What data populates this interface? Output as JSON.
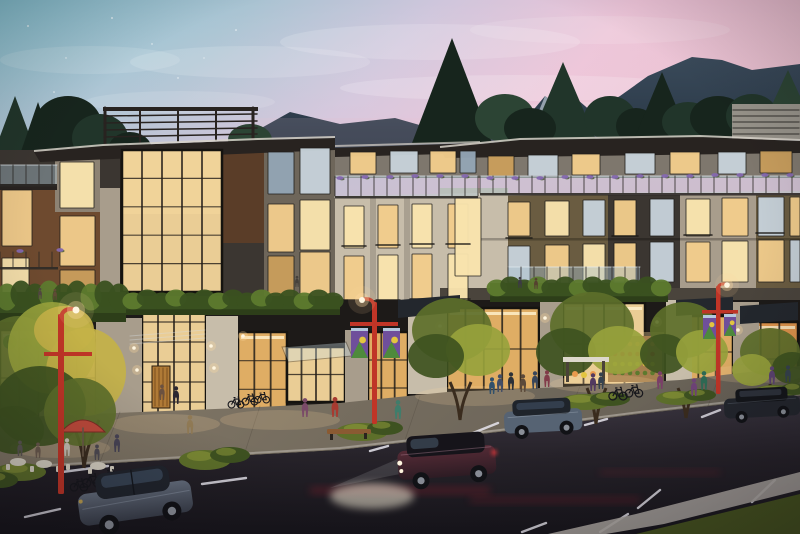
{
  "scene": {
    "type": "architectural-rendering",
    "time_of_day": "dusk",
    "label": "Dusk rendering of a mixed-use residential building with lit shops, tree-lined street, parked cars and mountains behind"
  },
  "palette": {
    "sky_teal": "#84bfce",
    "sky_mid": "#cfc6dc",
    "sky_pink": "#ecc3d7",
    "sky_rose": "#e9bccc",
    "mountain": "#2f3d4a",
    "mountain_dark": "#243240",
    "snow": "#aeb9c4",
    "tree_dark": "#17251d",
    "tree_mid": "#21352a",
    "tree_soft": "#2c4434",
    "roof": "#282320",
    "fascia": "#d7d2c9",
    "roof_screen": "#97938a",
    "wall_bronze": "#6e4a2f",
    "wall_taupe": "#8d8273",
    "wall_stone": "#c7bdaa",
    "wall_stone_dim": "#a89d8c",
    "wall_charcoal": "#3b3631",
    "wall_olive": "#6a5c41",
    "wall_gray": "#7e776d",
    "wall_wood": "#5a3d28",
    "glass_rail": "#a9c2cf",
    "rail_dark": "#2c2a27",
    "win_bright": "#f9e4ae",
    "win_warm": "#f2cd8c",
    "win_dim": "#c99e5c",
    "win_cool": "#c7d2da",
    "win_dusk": "#93a5b4",
    "win_dark": "#262b31",
    "store_glow": "#f6d79c",
    "store_amber": "#eab568",
    "store_orange": "#e89a4e",
    "hedge": "#3a5120",
    "hedge_lit": "#5d7a2e",
    "foliage_gold": "#c4b248",
    "foliage_lit": "#97a23c",
    "foliage_green": "#5d6f2a",
    "foliage_deep": "#3e5220",
    "trunk": "#3a2c1e",
    "pole_red": "#c03527",
    "banner_purple": "#6f4f9b",
    "banner_green": "#4e8a3c",
    "banner_yellow": "#e3c53f",
    "banner_sky": "#bcd6e4",
    "flower_purple": "#8568b0",
    "umbrella": "#bf4a3b",
    "furniture_light": "#d6d0c2",
    "door_wood": "#b07a36",
    "sign_green": "#3f9343",
    "pave_warm": "#857a68",
    "pave_cool": "#655f55",
    "curb": "#aaa49f",
    "asphalt_hi": "#3a3540",
    "asphalt": "#262229",
    "asphalt_deep": "#17151b",
    "mark_white": "#e8e6ee",
    "streak_red": "#b02430",
    "glow_warm": "#ffd9a0",
    "lamp_white": "#fff6e0",
    "grass": "#46531f",
    "car_gray": "#646d7c",
    "car_gray_dk": "#3a3f4b",
    "car_maroon": "#552b36",
    "car_maroon_dk": "#2e1c24",
    "car_blue": "#566373",
    "car_dark": "#23262d",
    "glass_car": "#3c4a5c",
    "wheel": "#111216",
    "rim": "#8a8f98"
  },
  "sky": {
    "stars": [
      [
        28,
        26,
        0.9
      ],
      [
        66,
        58,
        0.7
      ],
      [
        112,
        18,
        0.9
      ],
      [
        152,
        44,
        0.7
      ],
      [
        54,
        92,
        0.8
      ],
      [
        178,
        78,
        0.7
      ],
      [
        236,
        30,
        0.8
      ],
      [
        204,
        58,
        0.6
      ],
      [
        86,
        120,
        0.7
      ]
    ],
    "clouds": [
      [
        250,
        62,
        120,
        16,
        0.14
      ],
      [
        430,
        42,
        150,
        18,
        0.16
      ],
      [
        600,
        30,
        130,
        14,
        0.12
      ],
      [
        180,
        102,
        95,
        11,
        0.12
      ],
      [
        520,
        88,
        180,
        13,
        0.18
      ],
      [
        660,
        112,
        170,
        11,
        0.15
      ],
      [
        90,
        60,
        90,
        14,
        0.12
      ]
    ]
  },
  "bg_trees": [
    [
      "c",
      15,
      96,
      26,
      70,
      "tree_mid"
    ],
    [
      "c",
      38,
      102,
      22,
      64,
      "tree_dark"
    ],
    [
      "e",
      68,
      126,
      34,
      30,
      "tree_dark"
    ],
    [
      "e",
      100,
      138,
      28,
      24,
      "tree_mid"
    ],
    [
      "e",
      130,
      150,
      22,
      18,
      "tree_dark"
    ],
    [
      "e",
      250,
      140,
      22,
      16,
      "tree_soft"
    ],
    [
      "c",
      452,
      38,
      40,
      105,
      "tree_dark"
    ],
    [
      "c",
      563,
      62,
      34,
      80,
      "tree_mid"
    ],
    [
      "e",
      505,
      118,
      30,
      24,
      "tree_soft"
    ],
    [
      "e",
      530,
      128,
      26,
      20,
      "tree_dark"
    ],
    [
      "e",
      610,
      118,
      26,
      22,
      "tree_mid"
    ],
    [
      "e",
      636,
      126,
      20,
      18,
      "tree_dark"
    ],
    [
      "c",
      662,
      72,
      30,
      72,
      "tree_dark"
    ],
    [
      "e",
      688,
      122,
      26,
      20,
      "tree_mid"
    ],
    [
      "e",
      718,
      118,
      28,
      22,
      "tree_dark"
    ],
    [
      "e",
      752,
      116,
      26,
      22,
      "tree_mid"
    ],
    [
      "e",
      778,
      122,
      22,
      18,
      "tree_dark"
    ],
    [
      "c",
      788,
      70,
      22,
      48,
      "tree_soft"
    ]
  ],
  "windows": [
    [
      2,
      190,
      30,
      56,
      "w"
    ],
    [
      2,
      258,
      27,
      42,
      "b"
    ],
    [
      60,
      162,
      34,
      46,
      "b"
    ],
    [
      60,
      216,
      35,
      50,
      "w"
    ],
    [
      60,
      270,
      35,
      40,
      "d"
    ],
    [
      268,
      152,
      26,
      42,
      "k"
    ],
    [
      300,
      148,
      30,
      46,
      "c"
    ],
    [
      268,
      204,
      26,
      48,
      "w"
    ],
    [
      300,
      200,
      30,
      50,
      "b"
    ],
    [
      268,
      256,
      26,
      42,
      "d"
    ],
    [
      300,
      252,
      30,
      46,
      "w"
    ],
    [
      350,
      152,
      26,
      22,
      "w"
    ],
    [
      390,
      151,
      28,
      22,
      "c"
    ],
    [
      430,
      151,
      26,
      22,
      "w"
    ],
    [
      460,
      151,
      16,
      22,
      "k"
    ],
    [
      344,
      206,
      20,
      42,
      "b"
    ],
    [
      378,
      205,
      20,
      43,
      "w"
    ],
    [
      412,
      204,
      20,
      44,
      "b"
    ],
    [
      448,
      204,
      20,
      44,
      "w"
    ],
    [
      344,
      256,
      20,
      50,
      "w"
    ],
    [
      378,
      255,
      20,
      52,
      "b"
    ],
    [
      412,
      254,
      20,
      52,
      "w"
    ],
    [
      448,
      254,
      20,
      52,
      "b"
    ],
    [
      488,
      156,
      26,
      20,
      "d"
    ],
    [
      528,
      155,
      30,
      21,
      "c"
    ],
    [
      572,
      154,
      28,
      21,
      "w"
    ],
    [
      625,
      153,
      30,
      21,
      "c"
    ],
    [
      670,
      152,
      30,
      22,
      "w"
    ],
    [
      718,
      152,
      28,
      22,
      "c"
    ],
    [
      760,
      151,
      32,
      22,
      "d"
    ],
    [
      455,
      198,
      26,
      78,
      "b"
    ],
    [
      508,
      202,
      22,
      34,
      "w"
    ],
    [
      545,
      201,
      24,
      35,
      "b"
    ],
    [
      583,
      200,
      22,
      36,
      "c"
    ],
    [
      614,
      200,
      22,
      36,
      "w"
    ],
    [
      650,
      199,
      24,
      37,
      "c"
    ],
    [
      686,
      199,
      24,
      37,
      "b"
    ],
    [
      722,
      198,
      26,
      38,
      "w"
    ],
    [
      758,
      197,
      26,
      39,
      "c"
    ],
    [
      790,
      197,
      10,
      39,
      "w"
    ],
    [
      508,
      246,
      22,
      36,
      "c"
    ],
    [
      545,
      245,
      24,
      38,
      "w"
    ],
    [
      583,
      244,
      22,
      38,
      "b"
    ],
    [
      614,
      243,
      22,
      39,
      "w"
    ],
    [
      650,
      242,
      24,
      40,
      "c"
    ],
    [
      686,
      242,
      24,
      40,
      "w"
    ],
    [
      722,
      241,
      26,
      41,
      "b"
    ],
    [
      758,
      240,
      26,
      42,
      "w"
    ],
    [
      790,
      240,
      10,
      42,
      "c"
    ]
  ],
  "storefronts": [
    [
      122,
      150,
      100,
      142,
      "store_glow",
      4,
      4,
      0
    ],
    [
      0,
      330,
      96,
      96,
      "store_glow",
      4,
      1,
      1
    ],
    [
      142,
      302,
      64,
      120,
      "store_glow",
      3,
      5,
      0
    ],
    [
      238,
      332,
      49,
      86,
      "store_amber",
      2,
      2,
      1
    ],
    [
      287,
      347,
      58,
      55,
      "store_glow",
      3,
      1,
      0
    ],
    [
      368,
      332,
      40,
      84,
      "store_amber",
      2,
      2,
      0
    ],
    [
      447,
      308,
      92,
      82,
      "store_amber",
      4,
      1,
      1
    ],
    [
      563,
      303,
      82,
      82,
      "store_glow",
      3,
      1,
      1
    ],
    [
      681,
      316,
      52,
      72,
      "store_amber",
      2,
      1,
      0
    ],
    [
      742,
      322,
      56,
      74,
      "store_orange",
      2,
      1,
      1
    ]
  ],
  "balconies": [
    [
      0,
      165,
      57,
      19,
      "g"
    ],
    [
      335,
      176,
      143,
      20,
      "g"
    ],
    [
      480,
      176,
      320,
      17,
      "g"
    ],
    [
      508,
      267,
      132,
      20,
      "g"
    ],
    [
      0,
      252,
      58,
      15,
      "p"
    ],
    [
      0,
      300,
      58,
      14,
      "p"
    ]
  ],
  "rails": [
    [
      342,
      246,
      24
    ],
    [
      376,
      245,
      24
    ],
    [
      410,
      244,
      24
    ],
    [
      446,
      244,
      24
    ],
    [
      342,
      300,
      24
    ],
    [
      376,
      300,
      24
    ],
    [
      410,
      299,
      24
    ],
    [
      446,
      299,
      24
    ],
    [
      506,
      238,
      26
    ],
    [
      612,
      236,
      26
    ],
    [
      684,
      235,
      28
    ],
    [
      756,
      233,
      28
    ]
  ],
  "flowers": [
    [
      340,
      178
    ],
    [
      365,
      177
    ],
    [
      390,
      177
    ],
    [
      415,
      176
    ],
    [
      440,
      176
    ],
    [
      465,
      176
    ],
    [
      490,
      178
    ],
    [
      515,
      178
    ],
    [
      540,
      178
    ],
    [
      565,
      177
    ],
    [
      590,
      177
    ],
    [
      615,
      177
    ],
    [
      640,
      176
    ],
    [
      665,
      176
    ],
    [
      690,
      176
    ],
    [
      715,
      175
    ],
    [
      740,
      175
    ],
    [
      765,
      175
    ],
    [
      790,
      175
    ],
    [
      60,
      250
    ],
    [
      20,
      251
    ]
  ],
  "hedges": [
    [
      0,
      292,
      126,
      30
    ],
    [
      126,
      296,
      214,
      19
    ],
    [
      490,
      283,
      178,
      19
    ]
  ],
  "shrubs": [
    [
      205,
      460,
      26,
      10
    ],
    [
      230,
      455,
      20,
      8
    ],
    [
      362,
      432,
      26,
      9
    ],
    [
      385,
      428,
      18,
      7
    ],
    [
      585,
      402,
      26,
      8
    ],
    [
      610,
      399,
      20,
      7
    ],
    [
      678,
      398,
      22,
      7
    ],
    [
      700,
      395,
      16,
      6
    ],
    [
      775,
      392,
      22,
      7
    ],
    [
      795,
      389,
      14,
      6
    ],
    [
      20,
      472,
      26,
      9
    ],
    [
      0,
      480,
      18,
      8
    ]
  ],
  "fg_foliage": [
    [
      18,
      368,
      42,
      52,
      "foliage_green"
    ],
    [
      52,
      348,
      44,
      46,
      "foliage_lit"
    ],
    [
      86,
      372,
      40,
      44,
      "foliage_gold"
    ],
    [
      40,
      406,
      46,
      40,
      "foliage_deep"
    ],
    [
      80,
      412,
      36,
      34,
      "foliage_green"
    ],
    [
      14,
      430,
      30,
      24,
      "foliage_deep"
    ],
    [
      64,
      330,
      30,
      24,
      "foliage_gold"
    ],
    [
      452,
      330,
      40,
      32,
      "foliage_green"
    ],
    [
      478,
      350,
      32,
      26,
      "foliage_lit"
    ],
    [
      436,
      356,
      28,
      22,
      "foliage_deep"
    ],
    [
      592,
      326,
      42,
      34,
      "foliage_green"
    ],
    [
      566,
      352,
      30,
      24,
      "foliage_deep"
    ],
    [
      618,
      350,
      30,
      24,
      "foliage_lit"
    ],
    [
      684,
      330,
      34,
      28,
      "foliage_green"
    ],
    [
      664,
      354,
      24,
      20,
      "foliage_deep"
    ],
    [
      702,
      352,
      26,
      22,
      "foliage_lit"
    ],
    [
      770,
      352,
      30,
      24,
      "foliage_green"
    ],
    [
      792,
      368,
      20,
      16,
      "foliage_deep"
    ],
    [
      752,
      370,
      20,
      16,
      "foliage_lit"
    ]
  ],
  "produce_rows": [
    [
      344,
      "store_orange",
      615,
      6,
      7.5
    ],
    [
      354,
      "streak_red",
      615,
      6,
      7.5
    ],
    [
      364,
      "banner_yellow",
      615,
      6,
      7.5
    ],
    [
      373,
      "hedge_lit",
      615,
      6,
      7.5
    ]
  ],
  "road_marks": [
    [
      62,
      472,
      108,
      466
    ],
    [
      128,
      492,
      166,
      484
    ],
    [
      25,
      517,
      60,
      509
    ],
    [
      202,
      484,
      246,
      478
    ],
    [
      370,
      451,
      388,
      446
    ],
    [
      458,
      439,
      498,
      423
    ],
    [
      585,
      425,
      607,
      419
    ],
    [
      702,
      417,
      720,
      410
    ],
    [
      638,
      508,
      660,
      490
    ],
    [
      752,
      502,
      775,
      480
    ],
    [
      600,
      532,
      628,
      514
    ],
    [
      522,
      532,
      546,
      523
    ]
  ],
  "light_pools": [
    [
      165,
      424,
      55,
      10
    ],
    [
      280,
      420,
      60,
      10
    ],
    [
      475,
      396,
      60,
      10
    ],
    [
      605,
      384,
      55,
      9
    ],
    [
      755,
      374,
      50,
      9
    ],
    [
      60,
      448,
      50,
      10
    ]
  ],
  "sconces": [
    [
      134,
      348
    ],
    [
      137,
      370
    ],
    [
      211,
      346
    ],
    [
      214,
      368
    ],
    [
      243,
      336
    ],
    [
      440,
      326
    ],
    [
      545,
      318
    ],
    [
      657,
      322
    ],
    [
      738,
      330
    ],
    [
      92,
      336
    ]
  ],
  "banners": [
    [
      351,
      328,
      17,
      30
    ],
    [
      383,
      328,
      17,
      30
    ],
    [
      703,
      315,
      13,
      24
    ],
    [
      724,
      314,
      12,
      22
    ]
  ],
  "people": [
    [
      297,
      287,
      0.5,
      "#45403b"
    ],
    [
      520,
      288,
      0.5,
      "#3c3a44"
    ],
    [
      536,
      289,
      0.5,
      "#55412f"
    ],
    [
      40,
      299,
      0.5,
      "#514740"
    ],
    [
      55,
      300,
      0.5,
      "#5f4a35"
    ],
    [
      176,
      404,
      0.8,
      "#2b2731"
    ],
    [
      190,
      434,
      0.85,
      "#907a55"
    ],
    [
      162,
      400,
      0.7,
      "#6b5140"
    ],
    [
      335,
      417,
      0.9,
      "#a83a30"
    ],
    [
      305,
      417,
      0.85,
      "#7a4a68"
    ],
    [
      398,
      419,
      0.85,
      "#3f7d6b"
    ],
    [
      500,
      392,
      0.8,
      "#424d66"
    ],
    [
      511,
      390,
      0.8,
      "#2c3138"
    ],
    [
      523,
      392,
      0.8,
      "#5c4a3a"
    ],
    [
      535,
      389,
      0.8,
      "#39465a"
    ],
    [
      547,
      387,
      0.75,
      "#823c4a"
    ],
    [
      492,
      394,
      0.75,
      "#31506b"
    ],
    [
      593,
      391,
      0.8,
      "#523a60"
    ],
    [
      601,
      389,
      0.75,
      "#35424f"
    ],
    [
      660,
      389,
      0.8,
      "#7a3f68"
    ],
    [
      694,
      396,
      0.8,
      "#6f4478"
    ],
    [
      704,
      390,
      0.85,
      "#2e6b55"
    ],
    [
      772,
      384,
      0.8,
      "#5d4472"
    ],
    [
      788,
      382,
      0.75,
      "#36424e"
    ],
    [
      67,
      456,
      0.8,
      "#c8c2b6"
    ],
    [
      20,
      456,
      0.7,
      "#5b5652"
    ],
    [
      38,
      458,
      0.7,
      "#6b5a4e"
    ],
    [
      97,
      460,
      0.7,
      "#4e4a52"
    ],
    [
      117,
      452,
      0.8,
      "#474355"
    ]
  ],
  "bikes": [
    [
      92,
      487,
      1.2
    ],
    [
      110,
      483,
      1.2
    ],
    [
      79,
      491,
      1.1
    ],
    [
      236,
      408,
      1.0
    ],
    [
      250,
      405,
      1.0
    ],
    [
      262,
      403,
      0.95
    ],
    [
      618,
      400,
      1.15
    ],
    [
      634,
      397,
      1.1
    ]
  ]
}
